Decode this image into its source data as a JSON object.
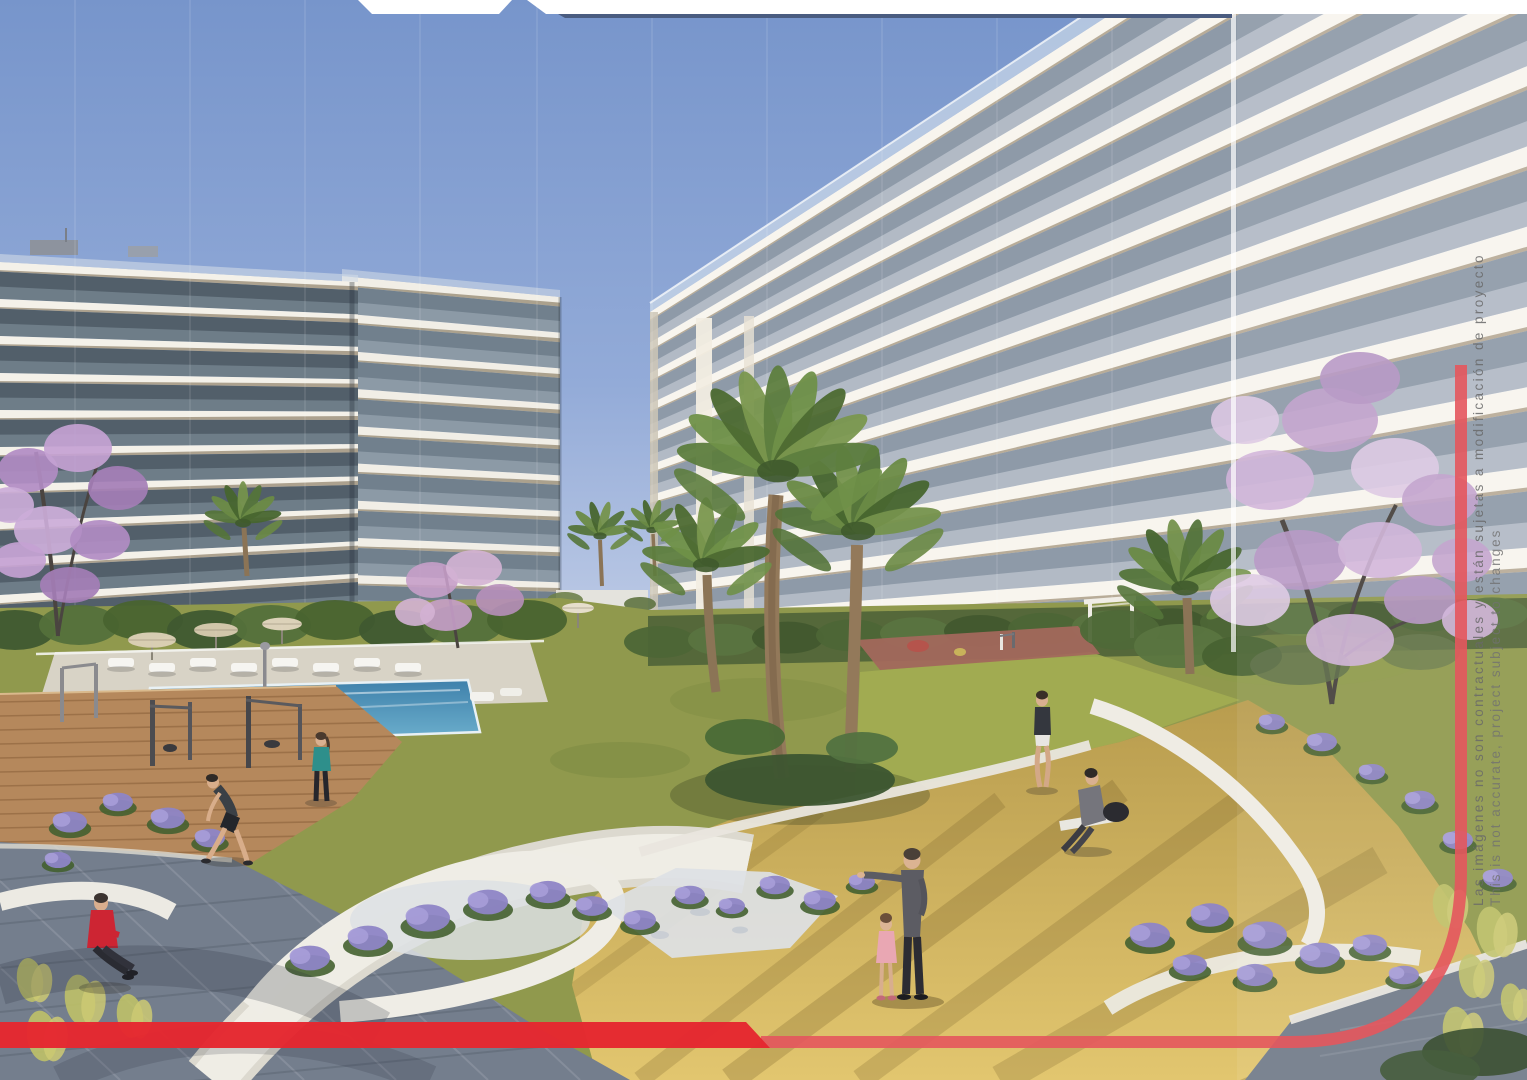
{
  "disclaimer": {
    "line_es": "Las imágenes no son contractuales y están sujetas a modificación de proyecto",
    "line_en": "This is not accurate, project subject to changes"
  },
  "frame": {
    "accent_red": "#e5272f",
    "thin_red": "#e4565d",
    "navy_line": "#4a5c80",
    "band_white": "#ffffff"
  }
}
